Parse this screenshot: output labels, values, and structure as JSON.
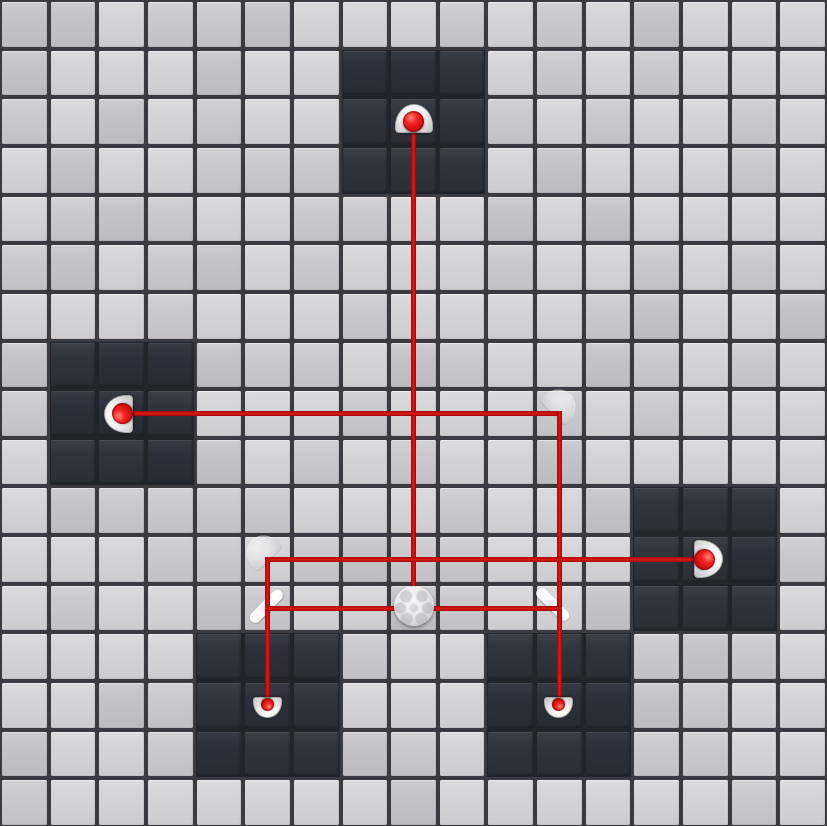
{
  "scene": {
    "name": "laser-grid-puzzle",
    "grid": {
      "cols": 17,
      "rows": 17,
      "width_px": 827,
      "height_px": 826
    },
    "colors": {
      "tile_light": "#d5d5d8",
      "tile_light_alt1": "#cacace",
      "tile_light_alt2": "#c3c3c8",
      "tile_dark": "#30343d",
      "tile_dark_alt": "#2c303a",
      "line_light": "#3a3a40",
      "line_dark": "#22242b",
      "beam_core": "#e01515",
      "beam_edge": "#8e0a0a",
      "dome": "#ececee",
      "laser_ball": "#e11313"
    },
    "dark_regions": [
      {
        "col": 7,
        "row": 1,
        "cols": 3,
        "rows": 3
      },
      {
        "col": 1,
        "row": 7,
        "cols": 3,
        "rows": 3
      },
      {
        "col": 13,
        "row": 10,
        "cols": 3,
        "rows": 3
      },
      {
        "col": 4,
        "row": 13,
        "cols": 3,
        "rows": 3
      },
      {
        "col": 10,
        "row": 13,
        "cols": 3,
        "rows": 3
      }
    ],
    "beams": [
      {
        "name": "beam-top-emitter-to-ball",
        "from": [
          8,
          2
        ],
        "to": [
          8,
          12
        ]
      },
      {
        "name": "beam-left-emitter-to-corner",
        "from": [
          2,
          8
        ],
        "to": [
          11,
          8
        ]
      },
      {
        "name": "beam-corner-to-right-receiver",
        "from": [
          11,
          8
        ],
        "to": [
          11,
          14
        ]
      },
      {
        "name": "beam-right-emitter-to-corner",
        "from": [
          5,
          11
        ],
        "to": [
          14,
          11
        ]
      },
      {
        "name": "beam-corner-to-left-receiver",
        "from": [
          5,
          11
        ],
        "to": [
          5,
          14
        ]
      },
      {
        "name": "beam-ball-between-mirrors",
        "from": [
          5,
          12
        ],
        "to": [
          11,
          12
        ]
      }
    ],
    "pieces": [
      {
        "type": "emitter",
        "name": "laser-emitter-top",
        "col": 8,
        "row": 2,
        "rot": 0,
        "dx": 0,
        "dy": 0
      },
      {
        "type": "emitter",
        "name": "laser-emitter-left",
        "col": 2,
        "row": 8,
        "rot": -90,
        "dx": 0,
        "dy": 0
      },
      {
        "type": "emitter",
        "name": "laser-emitter-right",
        "col": 14,
        "row": 11,
        "rot": 90,
        "dx": 0,
        "dy": 0
      },
      {
        "type": "receiver",
        "name": "laser-receiver-bottom-left",
        "col": 5,
        "row": 14,
        "rot": 180,
        "dx": 0,
        "dy": 0
      },
      {
        "type": "receiver",
        "name": "laser-receiver-bottom-right",
        "col": 11,
        "row": 14,
        "rot": 180,
        "dx": 0,
        "dy": 0
      },
      {
        "type": "checker-ball",
        "name": "splitter-ball",
        "col": 8,
        "row": 12,
        "rot": 0,
        "dx": 0,
        "dy": -2
      },
      {
        "type": "mirror-bar",
        "name": "mirror-bar-left",
        "col": 5,
        "row": 12,
        "rot": -45,
        "dx": -2,
        "dy": -2
      },
      {
        "type": "mirror-bar",
        "name": "mirror-bar-right",
        "col": 11,
        "row": 12,
        "rot": 45,
        "dx": -6,
        "dy": -4
      },
      {
        "type": "ghost-dome",
        "name": "ghost-mirror-left",
        "col": 5,
        "row": 11,
        "rot": -45,
        "dx": -6,
        "dy": -8
      },
      {
        "type": "ghost-dome",
        "name": "ghost-mirror-right",
        "col": 11,
        "row": 8,
        "rot": 45,
        "dx": 1,
        "dy": -9
      }
    ]
  }
}
